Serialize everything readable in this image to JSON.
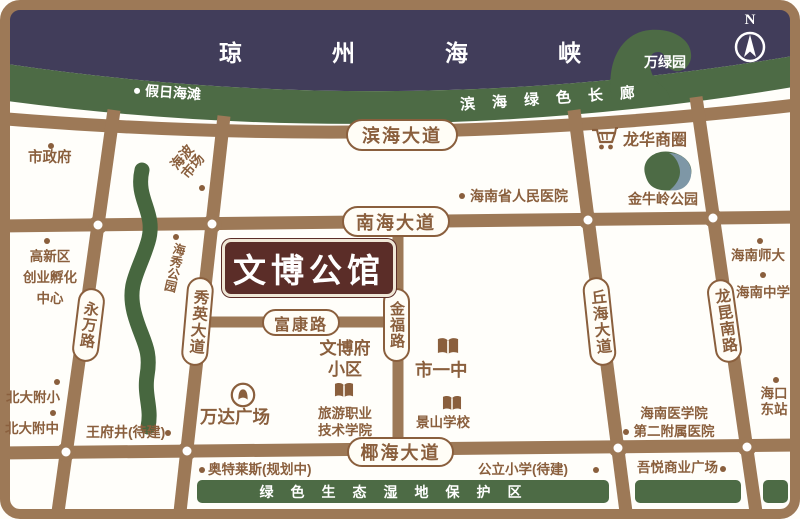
{
  "compass": {
    "north_label": "N"
  },
  "sea": {
    "strait": "琼州海峡"
  },
  "coast": {
    "beach": "假日海滩",
    "corridor": "滨海绿色长廊",
    "wanlv_park": "万绿园"
  },
  "roads": {
    "binhai": "滨海大道",
    "nanhai": "南海大道",
    "yehai": "椰海大道",
    "fukang": "富康路",
    "jinfu": "金福路",
    "yongwan": "永万路",
    "xiuying": "秀英大道",
    "qiuhai": "丘海大道",
    "longkun": "龙昆南路"
  },
  "estate": {
    "name": "文博公馆"
  },
  "wetland": {
    "label": "绿色生态湿地保护区"
  },
  "pois": {
    "city_government": {
      "label": "市政府"
    },
    "haibo_market": {
      "line1": "海波",
      "line2": "市场"
    },
    "peoples_hospital": {
      "label": "海南省人民医院"
    },
    "longhua_cbd": {
      "label": "龙华商圈"
    },
    "jinniuling_park": {
      "label": "金牛岭公园"
    },
    "hainan_normal_univ": {
      "label": "海南师大"
    },
    "hainan_middle_school": {
      "label": "海南中学"
    },
    "haikou_east_station": {
      "line1": "海口",
      "line2": "东站"
    },
    "incubation_center": {
      "line1": "高新区",
      "line2": "创业孵化",
      "line3": "中心"
    },
    "haixiu_park": {
      "label": "海秀公园"
    },
    "wenbofu": {
      "line1": "文博府",
      "line2": "小区"
    },
    "no1_middle_school": {
      "label": "市一中"
    },
    "jingshan_school": {
      "label": "景山学校"
    },
    "tourism_college": {
      "line1": "旅游职业",
      "line2": "技术学院"
    },
    "wanda_plaza": {
      "label": "万达广场"
    },
    "wangfujing": {
      "label": "王府井(待建)"
    },
    "pku_primary": {
      "label": "北大附小"
    },
    "pku_middle": {
      "label": "北大附中"
    },
    "outlets": {
      "label": "奥特莱斯(规划中)"
    },
    "public_primary": {
      "label": "公立小学(待建)"
    },
    "wuyue_plaza": {
      "label": "吾悦商业广场"
    },
    "medical_college_hospital": {
      "line1": "海南医学院",
      "line2": "第二附属医院"
    }
  },
  "colors": {
    "road_brown": "#9d7957",
    "sea_navy": "#413d5a",
    "park_green": "#4d6b45",
    "estate_maroon": "#5b2d28",
    "label_brown": "#8a5f3d",
    "water_teal": "#7e97a6"
  }
}
